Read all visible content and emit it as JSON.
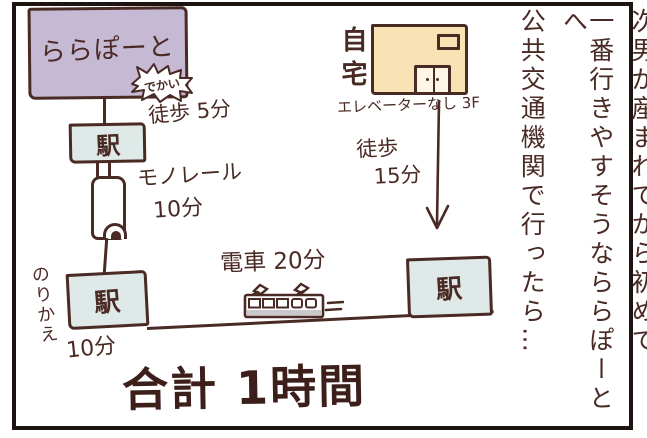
{
  "colors": {
    "ink": "#4a2a24",
    "frame": "#1d1412",
    "lalaport_fill": "#c6b9d3",
    "station_fill": "#dfe9e7",
    "home_fill": "#f9e3b4",
    "train_stripe": "#c9c9c9",
    "background": "#ffffff"
  },
  "narration": {
    "lines": [
      "次男が産まれてから初めて",
      "一番行きやすそうなららぽーとへ",
      "公共交通機関で行ったら…"
    ]
  },
  "map": {
    "lalaport_label": "ららぽーと",
    "dekai_bubble": "でかい",
    "walk5_label": "徒歩 5分",
    "station_label_1": "駅",
    "monorail_label": "モノレール",
    "monorail_duration": "10分",
    "norikae_label": "のりかえ",
    "station_label_2": "駅",
    "transfer_duration": "10分",
    "train_label": "電車 20分",
    "station_label_3": "駅",
    "home_label": "自宅",
    "home_note": "エレベーターなし 3F",
    "walk15_label": "徒歩",
    "walk15_duration": "15分",
    "total_label": "合計 1時間"
  }
}
